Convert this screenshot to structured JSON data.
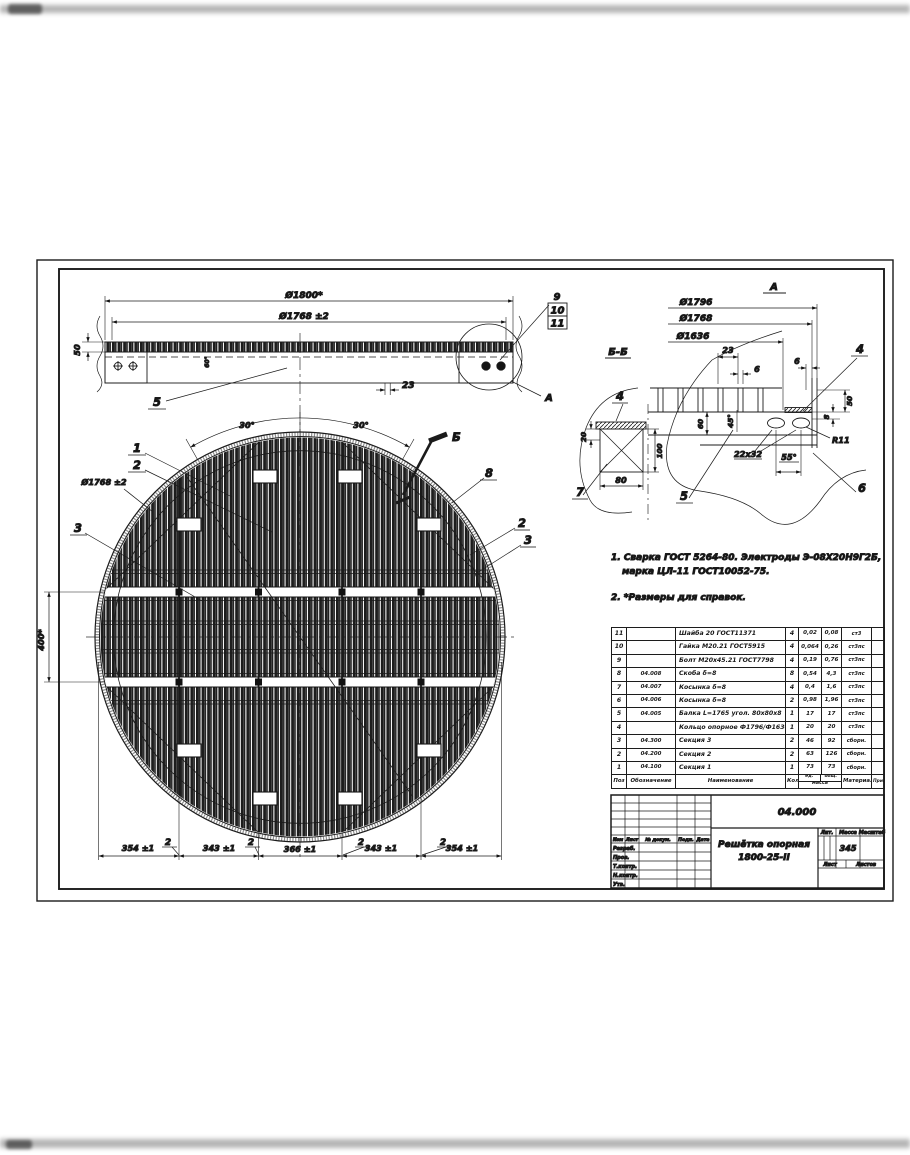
{
  "elevation": {
    "d1800": "Ø1800*",
    "d1768": "Ø1768 ±2",
    "d50": "50",
    "weld": "60°",
    "d23": "23",
    "pos5": "5",
    "pos9": "9",
    "pos10": "10",
    "pos11": "11",
    "detail_label": "А"
  },
  "plan": {
    "d1768": "Ø1768 ±2",
    "d400": "400*",
    "ang_left": "30°",
    "ang_right": "30°",
    "pos1": "1",
    "pos2": "2",
    "pos3": "3",
    "pos8": "8",
    "pos2_right": "2",
    "pos3_right": "3",
    "section_flag": "Б",
    "bottom_dims": [
      "354 ±1",
      "343 ±1",
      "366 ±1",
      "343 ±1",
      "354 ±1"
    ],
    "gap_label": "2"
  },
  "section_bb": {
    "title": "Б-Б",
    "pos4": "4",
    "pos7": "7",
    "d20": "20",
    "d100": "100",
    "d80": "80"
  },
  "detail_a": {
    "title": "А",
    "d1796": "Ø1796",
    "d1768": "Ø1768",
    "d1636": "Ø1636",
    "d23": "23",
    "d6_left": "6",
    "d6_right": "6",
    "d60": "60",
    "d45": "45°",
    "d50": "50",
    "d8": "8",
    "r11": "R11",
    "slot": "22x32",
    "d55": "55°",
    "pos4": "4",
    "pos5": "5",
    "pos6": "6"
  },
  "notes": {
    "n1": "1. Сварка ГОСТ 5264-80.   Электроды Э-08Х20Н9Г2Б,",
    "n1b": "марка ЦЛ-11 ГОСТ10052-75.",
    "n2": "2. *Размеры для справок."
  },
  "bom": {
    "headers": {
      "pos": "Поз",
      "designation": "Обозначение",
      "name": "Наименование",
      "qty": "Кол",
      "mass_unit": "ед.",
      "mass_total": "общ.",
      "mass": "масса",
      "material": "Материал",
      "note": "Прим"
    },
    "rows": [
      {
        "pos": "11",
        "designation": "",
        "name": "Шайба 20  ГОСТ11371",
        "qty": "4",
        "mass_unit": "0,02",
        "mass_total": "0,08",
        "material": "ст3"
      },
      {
        "pos": "10",
        "designation": "",
        "name": "Гайка М20.21   ГОСТ5915",
        "qty": "4",
        "mass_unit": "0,064",
        "mass_total": "0,26",
        "material": "ст3пс"
      },
      {
        "pos": "9",
        "designation": "",
        "name": "Болт М20х45.21  ГОСТ7798",
        "qty": "4",
        "mass_unit": "0,19",
        "mass_total": "0,76",
        "material": "ст3пс"
      },
      {
        "pos": "8",
        "designation": "04.008",
        "name": "Скоба  δ=8",
        "qty": "8",
        "mass_unit": "0,54",
        "mass_total": "4,3",
        "material": "ст3пс"
      },
      {
        "pos": "7",
        "designation": "04.007",
        "name": "Косынка  δ=8",
        "qty": "4",
        "mass_unit": "0,4",
        "mass_total": "1,6",
        "material": "ст3пс"
      },
      {
        "pos": "6",
        "designation": "04.006",
        "name": "Косынка  δ=8",
        "qty": "2",
        "mass_unit": "0,98",
        "mass_total": "1,96",
        "material": "ст3пс"
      },
      {
        "pos": "5",
        "designation": "04.005",
        "name": "Балка L=1765  угол. 80х80х8",
        "qty": "1",
        "mass_unit": "17",
        "mass_total": "17",
        "material": "ст3пс"
      },
      {
        "pos": "4",
        "designation": "",
        "name": "Кольцо опорное Ф1796/Ф1636 δ=8",
        "qty": "1",
        "mass_unit": "20",
        "mass_total": "20",
        "material": "ст3пс"
      },
      {
        "pos": "3",
        "designation": "04.300",
        "name": "Секция 3",
        "qty": "2",
        "mass_unit": "46",
        "mass_total": "92",
        "material": "сборн."
      },
      {
        "pos": "2",
        "designation": "04.200",
        "name": "Секция 2",
        "qty": "2",
        "mass_unit": "63",
        "mass_total": "126",
        "material": "сборн."
      },
      {
        "pos": "1",
        "designation": "04.100",
        "name": "Секция 1",
        "qty": "1",
        "mass_unit": "73",
        "mass_total": "73",
        "material": "сборн."
      }
    ]
  },
  "title_block": {
    "doc_number": "04.000",
    "title_line1": "Решётка опорная",
    "title_line2": "1800-25-II",
    "lit": "Лит.",
    "mass": "Масса",
    "scale": "Масштаб",
    "mass_value": "345",
    "sheet": "Лист",
    "sheets": "Листов",
    "col_izm": "Изм",
    "col_list": "Лист",
    "col_doc": "№ докум.",
    "col_sign": "Подп.",
    "col_date": "Дата",
    "roles": [
      "Разраб.",
      "Пров.",
      "Т.контр.",
      "Н.контр.",
      "Утв."
    ]
  }
}
